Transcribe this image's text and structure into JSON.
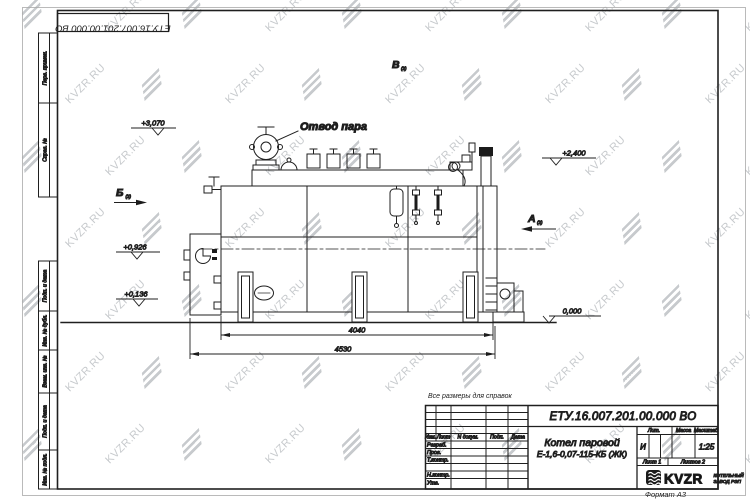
{
  "sheet": {
    "doc_number": "ЕТУ.16.007.201.00.000  ВО",
    "doc_number_flipped": "ЕТУ.16.007.201.00.000  ВО",
    "format_note": "Формат А3",
    "reference_note": "Все размеры для справок"
  },
  "margin_column": {
    "boxes": [
      {
        "label": "Перв. примен."
      },
      {
        "label": "Справ. №"
      },
      {
        "label": "Подп. и дата"
      },
      {
        "label": "Инв. № дубл."
      },
      {
        "label": "Взам. инв. №"
      },
      {
        "label": "Подп. и дата"
      },
      {
        "label": "Инв. № подл."
      }
    ]
  },
  "drawing": {
    "steam_outlet_label": "Отвод пара",
    "elevation_3070": "+3,070",
    "elevation_2400": "+2,400",
    "elevation_0926": "+0,926",
    "elevation_0136": "+0,136",
    "elevation_0000": "0,000",
    "dim_inner": "4040",
    "dim_outer": "4530",
    "view_b_label": "Б",
    "view_b_ref": "(2)",
    "view_v_label": "В",
    "view_v_ref": "(2)",
    "view_a_label": "А",
    "view_a_ref": "(2)"
  },
  "title_block": {
    "header": {
      "izm": "Изм.",
      "list": "Лист",
      "doc": "N докум.",
      "sign": "Подп.",
      "date": "Дата"
    },
    "rows": [
      {
        "label": "Разраб."
      },
      {
        "label": "Пров."
      },
      {
        "label": "Т.контр."
      },
      {
        "label": ""
      },
      {
        "label": "Н.контр."
      },
      {
        "label": "Утв."
      }
    ],
    "product_line1": "Котел паровой",
    "product_line2": "Е-1,6-0,07-115-КБ (ЖК)",
    "lit_header": "Лит.",
    "mass_header": "Масса",
    "scale_header": "Масштаб",
    "lit_value": "И",
    "scale_value": "1:25",
    "sheet_no": "Лист 1",
    "sheets_total": "Листов 2",
    "brand_name": "KVZR",
    "brand_sub_line1": "КОТЕЛЬНЫЙ",
    "brand_sub_line2": "ЗАВОД РЭП"
  },
  "watermark": {
    "text": "KVZR.RU",
    "color": "#8f959b",
    "opacity": 0.5
  }
}
